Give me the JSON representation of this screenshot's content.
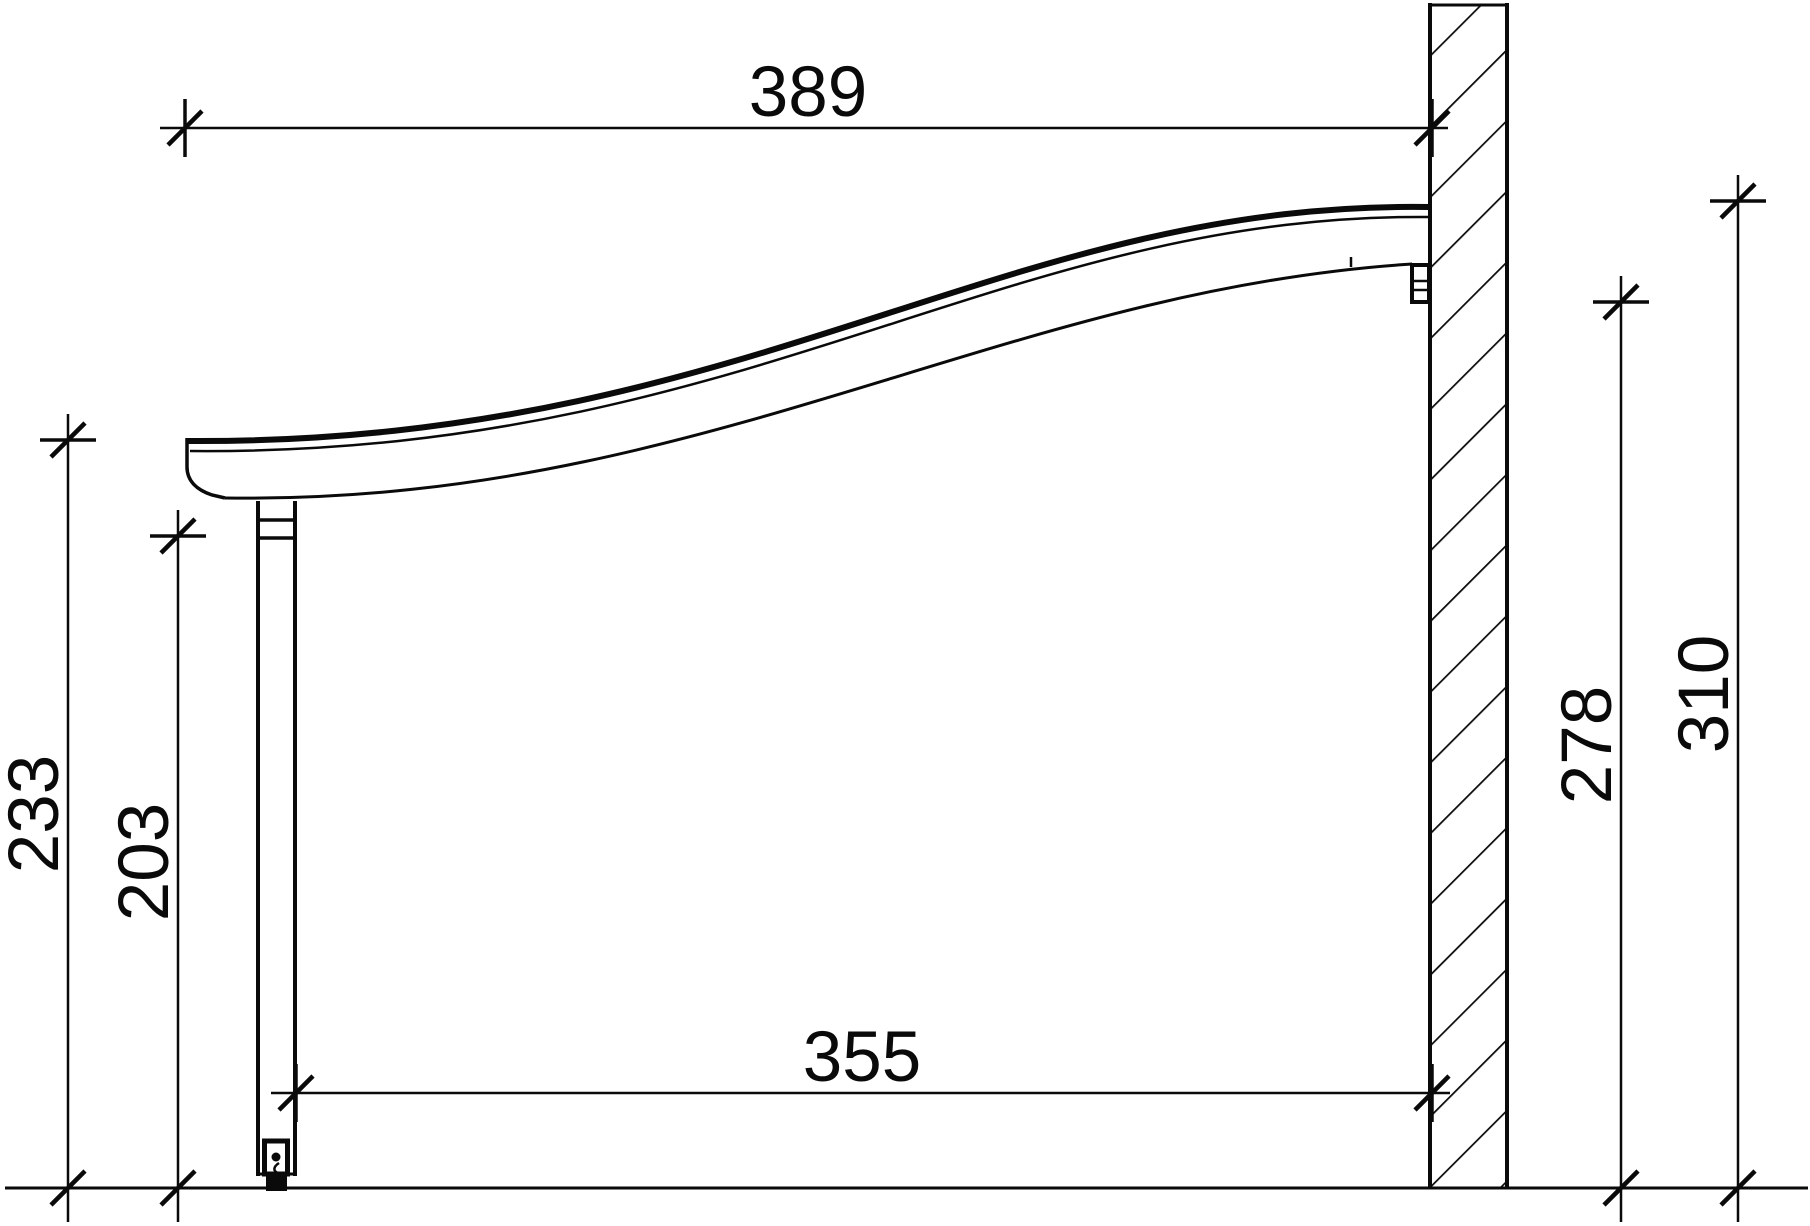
{
  "drawing": {
    "colors": {
      "line": "#0a0a0a",
      "background": "#ffffff"
    },
    "dimensions": {
      "roof_width_top": {
        "label": "389"
      },
      "front_total_height": {
        "label": "233"
      },
      "front_clear_height": {
        "label": "203"
      },
      "span_width_bottom": {
        "label": "355"
      },
      "wall_lower_height": {
        "label": "278"
      },
      "wall_upper_height": {
        "label": "310"
      }
    }
  }
}
